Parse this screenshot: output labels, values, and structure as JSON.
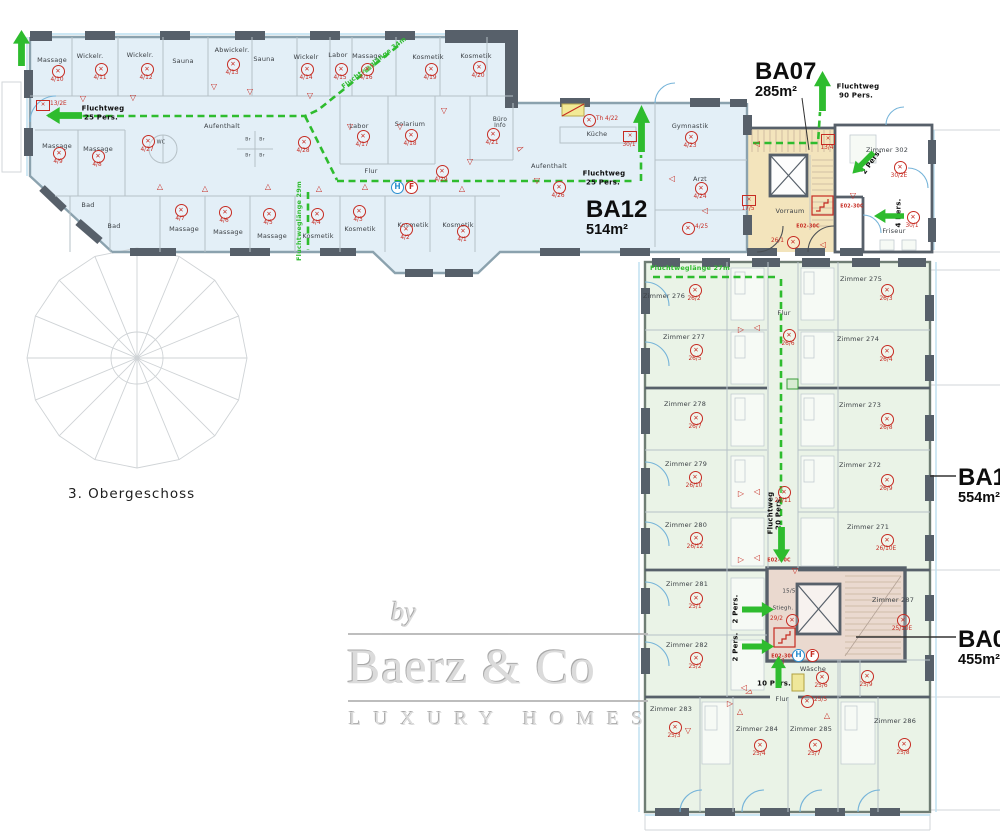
{
  "floor_label": "3. Obergeschoss",
  "areas": {
    "ba07": {
      "name": "BA07",
      "size": "285m²"
    },
    "ba12": {
      "name": "BA12",
      "size": "514m²"
    },
    "ba11": {
      "name": "BA11",
      "size": "554m²"
    },
    "ba04": {
      "name": "BA04",
      "size": "455m²"
    }
  },
  "watermark": {
    "by": "by",
    "brand": "Baerz & Co",
    "tagline": "LUXURY HOMES"
  },
  "colors": {
    "route": "#2ebc2e",
    "marker": "#c62b22",
    "wing_fill": "#e3eff7",
    "hotel_fill": "#eaf3e7",
    "stair07_fill": "#f3e4bc",
    "stair04_fill": "#ead9cf",
    "wall": "#57606a",
    "glass": "#bcdff0"
  },
  "labels": [
    {
      "t": "Massage",
      "x": 52,
      "y": 60
    },
    {
      "t": "Wickelr.",
      "x": 90,
      "y": 56
    },
    {
      "t": "Wickelr.",
      "x": 140,
      "y": 55
    },
    {
      "t": "Sauna",
      "x": 183,
      "y": 61
    },
    {
      "t": "Abwickelr.",
      "x": 232,
      "y": 50
    },
    {
      "t": "Sauna",
      "x": 264,
      "y": 59
    },
    {
      "t": "Wickelr",
      "x": 306,
      "y": 57
    },
    {
      "t": "Labor",
      "x": 338,
      "y": 55
    },
    {
      "t": "Massage",
      "x": 367,
      "y": 56
    },
    {
      "t": "Kosmetik",
      "x": 428,
      "y": 57
    },
    {
      "t": "Kosmetik",
      "x": 476,
      "y": 56
    },
    {
      "t": "Massage",
      "x": 57,
      "y": 146
    },
    {
      "t": "Massage",
      "x": 98,
      "y": 149
    },
    {
      "t": "Aufenthalt",
      "x": 222,
      "y": 126
    },
    {
      "t": "Labor",
      "x": 359,
      "y": 126
    },
    {
      "t": "Solarium",
      "x": 410,
      "y": 124
    },
    {
      "t": "Büro",
      "x": 500,
      "y": 121,
      "s": 5.8
    },
    {
      "t": "Info",
      "x": 500,
      "y": 127,
      "s": 5.8
    },
    {
      "t": "Flur",
      "x": 371,
      "y": 171
    },
    {
      "t": "Bad",
      "x": 88,
      "y": 205
    },
    {
      "t": "Bad",
      "x": 114,
      "y": 226
    },
    {
      "t": "Massage",
      "x": 184,
      "y": 229
    },
    {
      "t": "Massage",
      "x": 228,
      "y": 232
    },
    {
      "t": "Massage",
      "x": 272,
      "y": 236
    },
    {
      "t": "Kosmetik",
      "x": 318,
      "y": 236
    },
    {
      "t": "Kosmetik",
      "x": 360,
      "y": 229
    },
    {
      "t": "Kosmetik",
      "x": 413,
      "y": 225
    },
    {
      "t": "Kosmetik",
      "x": 458,
      "y": 225
    },
    {
      "t": "Küche",
      "x": 597,
      "y": 134
    },
    {
      "t": "Aufenthalt",
      "x": 549,
      "y": 166
    },
    {
      "t": "Gymnastik",
      "x": 690,
      "y": 126
    },
    {
      "t": "Arzt",
      "x": 700,
      "y": 179
    },
    {
      "t": "Vorraum",
      "x": 790,
      "y": 211
    },
    {
      "t": "Zimmer 302",
      "x": 887,
      "y": 150
    },
    {
      "t": "Friseur",
      "x": 894,
      "y": 231
    },
    {
      "t": "WC",
      "x": 161,
      "y": 143,
      "s": 5
    },
    {
      "t": "Br",
      "x": 248,
      "y": 141,
      "s": 4.6
    },
    {
      "t": "Br",
      "x": 262,
      "y": 141,
      "s": 4.6
    },
    {
      "t": "Br",
      "x": 248,
      "y": 157,
      "s": 4.6
    },
    {
      "t": "Br",
      "x": 262,
      "y": 157,
      "s": 4.6
    },
    {
      "t": "Zimmer 276",
      "x": 664,
      "y": 296
    },
    {
      "t": "Zimmer 275",
      "x": 861,
      "y": 279
    },
    {
      "t": "Zimmer 277",
      "x": 684,
      "y": 337
    },
    {
      "t": "Zimmer 274",
      "x": 858,
      "y": 339
    },
    {
      "t": "Flur",
      "x": 784,
      "y": 313
    },
    {
      "t": "Zimmer 278",
      "x": 685,
      "y": 404
    },
    {
      "t": "Zimmer 273",
      "x": 860,
      "y": 405
    },
    {
      "t": "Zimmer 279",
      "x": 686,
      "y": 464
    },
    {
      "t": "Zimmer 272",
      "x": 860,
      "y": 465
    },
    {
      "t": "Zimmer 280",
      "x": 686,
      "y": 525
    },
    {
      "t": "Zimmer 271",
      "x": 868,
      "y": 527
    },
    {
      "t": "Zimmer 281",
      "x": 687,
      "y": 584
    },
    {
      "t": "Zimmer 287",
      "x": 893,
      "y": 600
    },
    {
      "t": "Zimmer 282",
      "x": 687,
      "y": 645
    },
    {
      "t": "Zimmer 283",
      "x": 671,
      "y": 709
    },
    {
      "t": "Zimmer 284",
      "x": 757,
      "y": 729
    },
    {
      "t": "Zimmer 285",
      "x": 811,
      "y": 729
    },
    {
      "t": "Zimmer 286",
      "x": 895,
      "y": 721
    },
    {
      "t": "Flur",
      "x": 782,
      "y": 699
    },
    {
      "t": "Wäsche",
      "x": 813,
      "y": 669
    },
    {
      "t": "Stiegh.",
      "x": 783,
      "y": 609,
      "s": 5.5
    },
    {
      "t": "15/5",
      "x": 789,
      "y": 592,
      "s": 5.5
    },
    {
      "t": "Fluchtweg",
      "x": 103,
      "y": 109,
      "b": 1
    },
    {
      "t": "25 Pers.",
      "x": 101,
      "y": 118,
      "b": 1
    },
    {
      "t": "Fluchtweg",
      "x": 604,
      "y": 174,
      "b": 1
    },
    {
      "t": "25 Pers.",
      "x": 603,
      "y": 183,
      "b": 1
    },
    {
      "t": "Fluchtweg",
      "x": 858,
      "y": 87,
      "b": 1
    },
    {
      "t": "90 Pers.",
      "x": 856,
      "y": 96,
      "b": 1
    },
    {
      "t": "Fluchtweglänge 34m",
      "x": 374,
      "y": 63,
      "c": "g",
      "r": -38
    },
    {
      "t": "Fluchtweglänge 29m",
      "x": 299,
      "y": 221,
      "c": "g",
      "r": -90
    },
    {
      "t": "Fluchtweglänge 27m",
      "x": 690,
      "y": 268,
      "c": "g"
    },
    {
      "t": "Fluchtweg",
      "x": 771,
      "y": 513,
      "b": 1,
      "r": -90
    },
    {
      "t": "20 Pers.",
      "x": 779,
      "y": 513,
      "b": 1,
      "r": -90
    },
    {
      "t": "2 Pers.",
      "x": 736,
      "y": 609,
      "b": 1,
      "r": -90
    },
    {
      "t": "2 Pers.",
      "x": 736,
      "y": 647,
      "b": 1,
      "r": -90
    },
    {
      "t": "10 Pers.",
      "x": 774,
      "y": 684,
      "b": 1
    },
    {
      "t": "4 Pers.",
      "x": 899,
      "y": 213,
      "b": 1,
      "r": -90
    },
    {
      "t": "2 Pers.",
      "x": 872,
      "y": 162,
      "b": 1,
      "r": -55
    },
    {
      "t": "E02-30C",
      "x": 852,
      "y": 208,
      "c": "r"
    },
    {
      "t": "E02-30C",
      "x": 808,
      "y": 228,
      "c": "r"
    },
    {
      "t": "E02-30C",
      "x": 779,
      "y": 562,
      "c": "r"
    },
    {
      "t": "E02-30C",
      "x": 783,
      "y": 658,
      "c": "r"
    }
  ],
  "detectors": [
    {
      "c": "4/10",
      "x": 57,
      "y": 70
    },
    {
      "c": "4/11",
      "x": 100,
      "y": 68
    },
    {
      "c": "4/12",
      "x": 146,
      "y": 68
    },
    {
      "c": "4/13",
      "x": 232,
      "y": 63
    },
    {
      "c": "4/14",
      "x": 306,
      "y": 68
    },
    {
      "c": "4/15",
      "x": 340,
      "y": 68
    },
    {
      "c": "4/16",
      "x": 366,
      "y": 68
    },
    {
      "c": "4/19",
      "x": 430,
      "y": 68
    },
    {
      "c": "4/20",
      "x": 478,
      "y": 66
    },
    {
      "c": "4/9",
      "x": 58,
      "y": 152
    },
    {
      "c": "4/8",
      "x": 97,
      "y": 155
    },
    {
      "c": "4/27",
      "x": 147,
      "y": 140
    },
    {
      "c": "4/28",
      "x": 303,
      "y": 141
    },
    {
      "c": "4/17",
      "x": 362,
      "y": 135
    },
    {
      "c": "4/18",
      "x": 410,
      "y": 134
    },
    {
      "c": "4/21",
      "x": 492,
      "y": 133
    },
    {
      "c": "4/29",
      "x": 441,
      "y": 170
    },
    {
      "c": "4/26",
      "x": 558,
      "y": 186
    },
    {
      "c": "4/23",
      "x": 690,
      "y": 136
    },
    {
      "c": "4/24",
      "x": 700,
      "y": 187
    },
    {
      "c": "4/25",
      "x": 687,
      "y": 227,
      "p": "r"
    },
    {
      "c": "4/7",
      "x": 180,
      "y": 209
    },
    {
      "c": "4/6",
      "x": 224,
      "y": 211
    },
    {
      "c": "4/5",
      "x": 268,
      "y": 213
    },
    {
      "c": "4/4",
      "x": 316,
      "y": 213
    },
    {
      "c": "4/3",
      "x": 358,
      "y": 210
    },
    {
      "c": "4/2",
      "x": 405,
      "y": 228
    },
    {
      "c": "4/1",
      "x": 462,
      "y": 230
    },
    {
      "c": "Th 4/22",
      "x": 588,
      "y": 119,
      "p": "r"
    },
    {
      "c": "26/2",
      "x": 694,
      "y": 289
    },
    {
      "c": "26/3",
      "x": 886,
      "y": 289
    },
    {
      "c": "26/5",
      "x": 695,
      "y": 349
    },
    {
      "c": "26/4",
      "x": 886,
      "y": 350
    },
    {
      "c": "26/6",
      "x": 788,
      "y": 334
    },
    {
      "c": "26/7",
      "x": 695,
      "y": 417
    },
    {
      "c": "26/8",
      "x": 886,
      "y": 418
    },
    {
      "c": "26/10",
      "x": 694,
      "y": 476
    },
    {
      "c": "26/9",
      "x": 886,
      "y": 479
    },
    {
      "c": "26/11",
      "x": 783,
      "y": 491
    },
    {
      "c": "26/12",
      "x": 695,
      "y": 537
    },
    {
      "c": "26/10E",
      "x": 886,
      "y": 539
    },
    {
      "c": "25/1",
      "x": 695,
      "y": 597
    },
    {
      "c": "25/10E",
      "x": 902,
      "y": 619
    },
    {
      "c": "25/2",
      "x": 695,
      "y": 657
    },
    {
      "c": "25/3",
      "x": 674,
      "y": 726
    },
    {
      "c": "25/4",
      "x": 759,
      "y": 744
    },
    {
      "c": "25/7",
      "x": 814,
      "y": 744
    },
    {
      "c": "25/8",
      "x": 903,
      "y": 743
    },
    {
      "c": "25/5",
      "x": 806,
      "y": 700,
      "p": "r"
    },
    {
      "c": "25/6",
      "x": 821,
      "y": 676
    },
    {
      "c": "25/9",
      "x": 866,
      "y": 675
    },
    {
      "c": "30/2E",
      "x": 899,
      "y": 166
    },
    {
      "c": "30/1",
      "x": 912,
      "y": 216
    },
    {
      "c": "29/2",
      "x": 791,
      "y": 619,
      "p": "l"
    },
    {
      "c": "26/1",
      "x": 792,
      "y": 241,
      "p": "l"
    }
  ],
  "box_markers": [
    {
      "c": "13/2E",
      "x": 42,
      "y": 104,
      "p": "r"
    },
    {
      "c": "30/1",
      "x": 629,
      "y": 135
    },
    {
      "c": "17/5",
      "x": 748,
      "y": 199
    },
    {
      "c": "13/4",
      "x": 827,
      "y": 138
    }
  ],
  "door_markers": [
    {
      "g": "▽",
      "x": 83,
      "y": 99
    },
    {
      "g": "▽",
      "x": 133,
      "y": 98
    },
    {
      "g": "▽",
      "x": 214,
      "y": 87
    },
    {
      "g": "▽",
      "x": 250,
      "y": 92
    },
    {
      "g": "▽",
      "x": 310,
      "y": 96
    },
    {
      "g": "△",
      "x": 160,
      "y": 187
    },
    {
      "g": "△",
      "x": 205,
      "y": 189
    },
    {
      "g": "△",
      "x": 268,
      "y": 187
    },
    {
      "g": "△",
      "x": 319,
      "y": 189
    },
    {
      "g": "△",
      "x": 365,
      "y": 187
    },
    {
      "g": "△",
      "x": 462,
      "y": 189
    },
    {
      "g": "▽",
      "x": 444,
      "y": 111
    },
    {
      "g": "▽",
      "x": 470,
      "y": 162
    },
    {
      "g": "▽",
      "x": 537,
      "y": 181
    },
    {
      "g": "▽",
      "x": 350,
      "y": 127
    },
    {
      "g": "▽",
      "x": 400,
      "y": 127
    },
    {
      "g": "◁",
      "x": 672,
      "y": 179
    },
    {
      "g": "◁",
      "x": 705,
      "y": 211
    },
    {
      "g": "◁",
      "x": 757,
      "y": 144
    },
    {
      "g": "▽",
      "x": 853,
      "y": 196
    },
    {
      "g": "◁",
      "x": 823,
      "y": 245
    },
    {
      "g": "▷",
      "x": 741,
      "y": 330
    },
    {
      "g": "◁",
      "x": 757,
      "y": 328
    },
    {
      "g": "▷",
      "x": 741,
      "y": 494
    },
    {
      "g": "◁",
      "x": 757,
      "y": 492
    },
    {
      "g": "▷",
      "x": 741,
      "y": 560
    },
    {
      "g": "◁",
      "x": 757,
      "y": 558
    },
    {
      "g": "▷",
      "x": 730,
      "y": 704
    },
    {
      "g": "△",
      "x": 740,
      "y": 712
    },
    {
      "g": "△",
      "x": 827,
      "y": 716
    },
    {
      "g": "▽",
      "x": 688,
      "y": 731
    },
    {
      "g": "◁",
      "x": 744,
      "y": 688
    },
    {
      "g": "▽",
      "x": 795,
      "y": 571
    },
    {
      "g": "◁",
      "x": 781,
      "y": 661
    }
  ],
  "swing_arrows": [
    {
      "x": 521,
      "y": 149,
      "r": -25
    },
    {
      "x": 748,
      "y": 692,
      "r": 160
    }
  ],
  "hydrants": [
    {
      "x": 405,
      "y": 184,
      "h": "H",
      "f": "F"
    },
    {
      "x": 806,
      "y": 652,
      "h": "H",
      "f": "F"
    }
  ],
  "escape": {
    "arrows": [
      {
        "d": "up",
        "x": 13,
        "y": 30,
        "w": 17,
        "h": 36
      },
      {
        "d": "left",
        "x": 46,
        "y": 107,
        "w": 36,
        "h": 17
      },
      {
        "d": "up",
        "x": 633,
        "y": 105,
        "w": 17,
        "h": 47
      },
      {
        "d": "up",
        "x": 814,
        "y": 71,
        "w": 17,
        "h": 40
      },
      {
        "d": "down",
        "x": 773,
        "y": 527,
        "w": 17,
        "h": 36
      },
      {
        "d": "right",
        "x": 742,
        "y": 602,
        "w": 32,
        "h": 15
      },
      {
        "d": "right",
        "x": 742,
        "y": 639,
        "w": 32,
        "h": 15
      },
      {
        "d": "up",
        "x": 771,
        "y": 656,
        "w": 15,
        "h": 32
      },
      {
        "d": "left",
        "x": 874,
        "y": 209,
        "w": 30,
        "h": 14
      },
      {
        "d": "left",
        "x": 848,
        "y": 156,
        "w": 30,
        "h": 14,
        "r": -45
      }
    ],
    "routes": [
      [
        [
          48,
          116
        ],
        [
          305,
          116
        ]
      ],
      [
        [
          398,
          46
        ],
        [
          318,
          110
        ],
        [
          305,
          116
        ]
      ],
      [
        [
          305,
          116
        ],
        [
          337,
          180
        ]
      ],
      [
        [
          337,
          181
        ],
        [
          633,
          181
        ]
      ],
      [
        [
          641,
          181
        ],
        [
          641,
          155
        ]
      ],
      [
        [
          308,
          192
        ],
        [
          308,
          250
        ]
      ],
      [
        [
          753,
          143
        ],
        [
          818,
          143
        ],
        [
          820,
          112
        ]
      ],
      [
        [
          653,
          277
        ],
        [
          779,
          277
        ]
      ],
      [
        [
          781,
          279
        ],
        [
          781,
          525
        ]
      ]
    ]
  }
}
